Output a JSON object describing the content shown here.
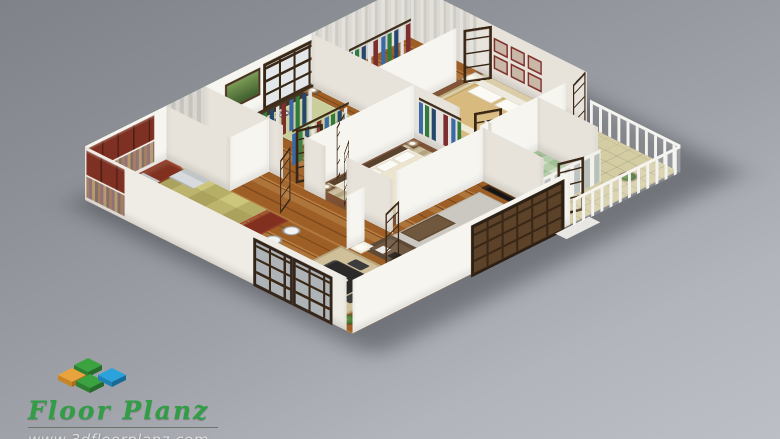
{
  "brand": {
    "name": "Floor Planz",
    "website": "www.3dfloorplanz.com",
    "name_color": "#2f9e44",
    "website_color": "#dfdfe1",
    "logo_block_colors": {
      "orange": "#e8a33c",
      "green": "#3aa33f",
      "blue": "#2aa3dd"
    }
  },
  "scene": {
    "type": "isometric-3d-floor-plan-render",
    "background_gradient": [
      "#7f8288",
      "#bcbfc5"
    ],
    "palette": {
      "wall_bright": "#f7f5f0",
      "wall_shaded": "#e7e3db",
      "wood_floor": "#9e5f26",
      "bedroom_carpet": "#7b4a2c",
      "kitchen_tile_border": "#a8503a",
      "kitchen_cabinets": "#7e3122",
      "dark_door_frames": "#3a2715",
      "sofa_brown": "#5d4936"
    },
    "rooms": [
      {
        "name": "kitchen",
        "contents": [
          "l-shaped-red-brown-cabinets",
          "upper-cabinets",
          "mosaic-backsplash",
          "stove-oven",
          "fridge",
          "breakfast-bar",
          "2-white-bar-stools",
          "checker-tile-floor"
        ]
      },
      {
        "name": "dining-area",
        "contents": [
          "black-dining-table",
          "4-dark-chairs",
          "beige-area-rug",
          "corner-plant",
          "dark-framed-windows"
        ]
      },
      {
        "name": "living-room",
        "contents": [
          "l-shaped-brown-sofa",
          "throw-pillows",
          "brown-ottoman",
          "white-coffee-table",
          "side-table-lamp",
          "tv-unit-with-flat-screen",
          "plants",
          "gray-rug",
          "dark-framed-front-window"
        ]
      },
      {
        "name": "master-bedroom",
        "contents": [
          "cream-double-bed",
          "white-pillows",
          "2-nightstands-with-lamps",
          "striped-rug",
          "tv-dresser",
          "open-clothes-rack",
          "brown-carpet"
        ]
      },
      {
        "name": "bedroom-2",
        "contents": [
          "green-double-bed",
          "dark-headboard",
          "checkered-pillows",
          "green-landscape-picture",
          "grid-window",
          "nightstand-lamp",
          "walk-in-closet-racks"
        ]
      },
      {
        "name": "bedroom-3",
        "contents": [
          "tan-double-bed",
          "white-headboard",
          "white-pillows",
          "6-framed-pictures",
          "patterned-rug",
          "white-nightstand-lamp",
          "closet-rack",
          "brown-carpet"
        ]
      },
      {
        "name": "bathroom-1",
        "contents": [
          "toilet",
          "washer",
          "sink",
          "patterned-wallpaper"
        ]
      },
      {
        "name": "bathroom-2",
        "contents": [
          "green-tile-floor",
          "white-mat",
          "plant"
        ]
      },
      {
        "name": "balcony",
        "contents": [
          "white-post-railing",
          "tan-tile-floor",
          "plant"
        ]
      }
    ]
  }
}
